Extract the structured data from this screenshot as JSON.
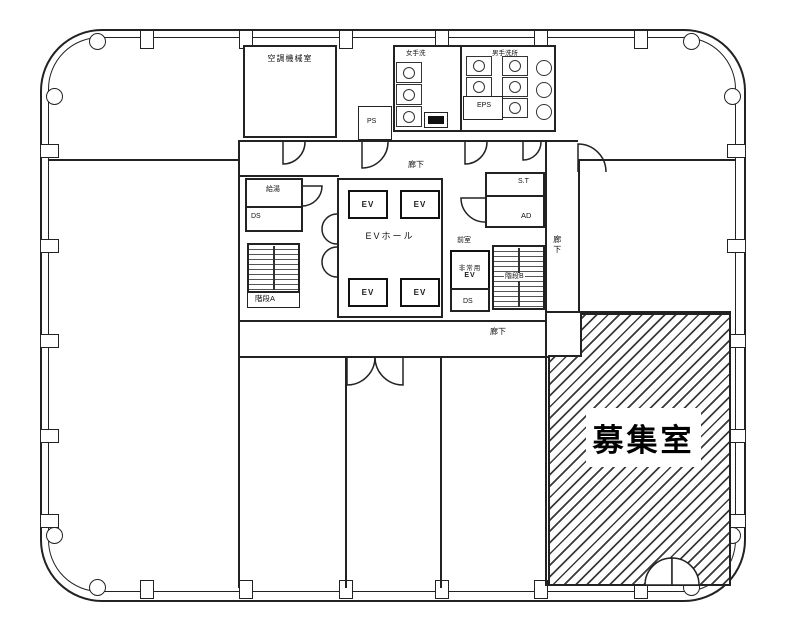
{
  "floorplan": {
    "title": "office-floor-plan",
    "vacant_room": "募集室",
    "rooms": {
      "machine_room": "空調機械室",
      "women_toilet": "女手洗",
      "men_toilet": "男手洗所",
      "ps": "PS",
      "eps": "EPS",
      "kyuto": "給湯",
      "ds": "DS",
      "stairs_a": "階段A",
      "stairs_b": "階段B",
      "ev": "EV",
      "ev_hall": "EVホール",
      "st": "S.T",
      "ad": "AD",
      "anteroom": "前室",
      "emergency_ev_line1": "非常用",
      "emergency_ev_line2": "EV",
      "corridor": "廊下"
    },
    "colors": {
      "line": "#222222",
      "background": "#ffffff",
      "hatch_line": "#3a3a3a"
    }
  }
}
